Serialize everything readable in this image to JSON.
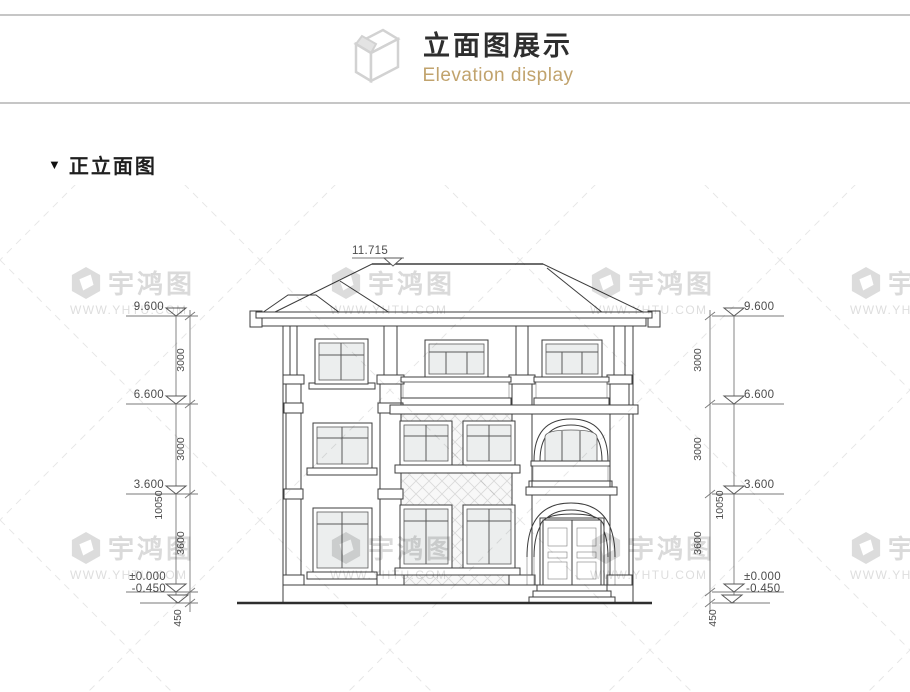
{
  "header": {
    "title": "立面图展示",
    "subtitle": "Elevation display",
    "icon": "isometric-box-icon"
  },
  "section": {
    "marker": "▼",
    "title": "正立面图"
  },
  "drawing": {
    "name": "front-elevation",
    "ridge_dim": "11.715",
    "levels": [
      {
        "label": "9.600"
      },
      {
        "label": "6.600"
      },
      {
        "label": "3.600"
      },
      {
        "label": "±0.000"
      },
      {
        "label": "-0.450"
      }
    ],
    "segments": [
      {
        "label": "3000"
      },
      {
        "label": "3000"
      },
      {
        "label": "3600"
      },
      {
        "label": "450"
      }
    ],
    "overall": "10050"
  },
  "watermark": {
    "brand": "宇鸿图",
    "url": "WWW.YHTU.COM"
  },
  "colors": {
    "subtitle_gold": "#c1a36d",
    "rule_gray": "#c6c6c6",
    "line_dark": "#3d3d3d",
    "watermark_gray": "#dcdcdc"
  }
}
